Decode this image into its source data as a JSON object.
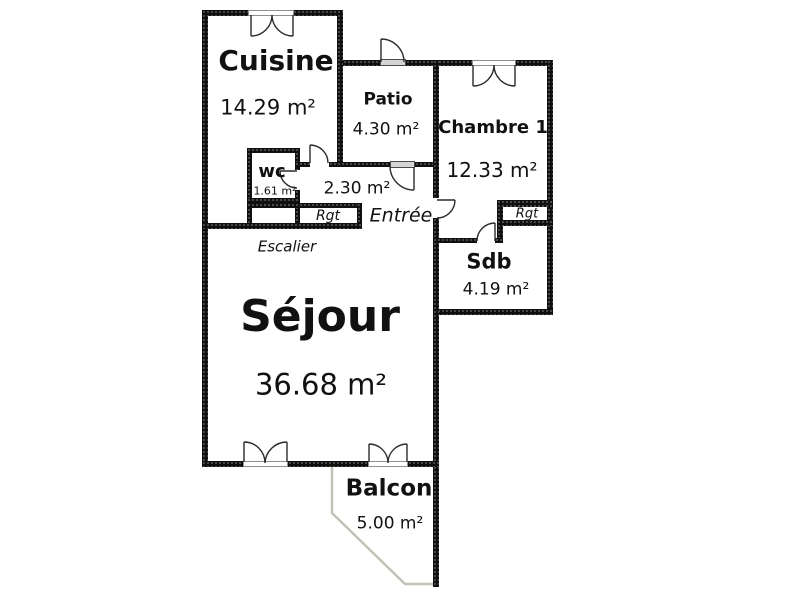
{
  "plan_type": "apartment-floor-plan",
  "rooms": {
    "cuisine": {
      "name": "Cuisine",
      "area": "14.29 m²"
    },
    "patio": {
      "name": "Patio",
      "area": "4.30 m²"
    },
    "chambre1": {
      "name": "Chambre 1",
      "area": "12.33 m²"
    },
    "wc": {
      "name": "wc",
      "area": "1.61 m²"
    },
    "hall": {
      "area": "2.30 m²"
    },
    "sdb": {
      "name": "Sdb",
      "area": "4.19 m²"
    },
    "sejour": {
      "name": "Séjour",
      "area": "36.68 m²"
    },
    "balcon": {
      "name": "Balcon",
      "area": "5.00 m²"
    }
  },
  "annotations": {
    "entree": "Entrée",
    "escalier": "Escalier",
    "rgt_left": "Rgt",
    "rgt_right": "Rgt"
  },
  "colors": {
    "wall": "#101010",
    "door_swing": "#2b2b2b",
    "door_panel": "#d4d4d4",
    "balcony_outline": "#c2c2b8",
    "background": "#ffffff"
  }
}
